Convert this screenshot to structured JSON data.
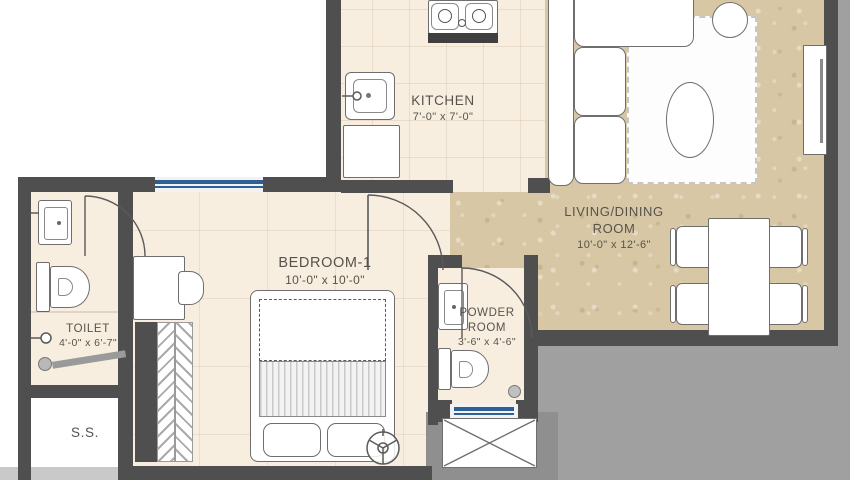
{
  "plan_title": "apartment-floor-plan",
  "rooms": {
    "kitchen": {
      "label": "KITCHEN",
      "dims": "7'-0\" x 7'-0\""
    },
    "living": {
      "label": "LIVING/DINING ROOM",
      "dims": "10'-0\" x 12'-6\""
    },
    "bedroom": {
      "label": "BEDROOM-1",
      "dims": "10'-0\" x 10'-0\""
    },
    "toilet": {
      "label": "TOILET",
      "dims": "4'-0\" x 6'-7\""
    },
    "powder": {
      "label": "POWDER ROOM",
      "dims": "3'-6\" x 4'-6\""
    },
    "ss": {
      "label": "S.S."
    }
  },
  "colors": {
    "wall": "#4f4f4f",
    "secondary_wall": "#8f8f8f",
    "floor_tile_cream": "#f7eee0",
    "floor_marble_tan": "#d8c7a5",
    "window_blue": "#2d5f94",
    "exterior_gray": "#a0a0a0",
    "label_text": "#57534b"
  },
  "fixtures": [
    "gas-hob",
    "kitchen-sink",
    "kitchen-counter",
    "sofa-l-shaped",
    "area-rug",
    "coffee-table-oval",
    "side-table-round",
    "tv-unit",
    "dining-table",
    "dining-chairs-4",
    "double-bed",
    "pillows",
    "wardrobe-chevron",
    "desk",
    "desk-chair",
    "ceiling-fan",
    "wc-toilet",
    "washbasin",
    "shower-area",
    "floor-drain",
    "duct-shaft",
    "windows",
    "door-swings"
  ]
}
